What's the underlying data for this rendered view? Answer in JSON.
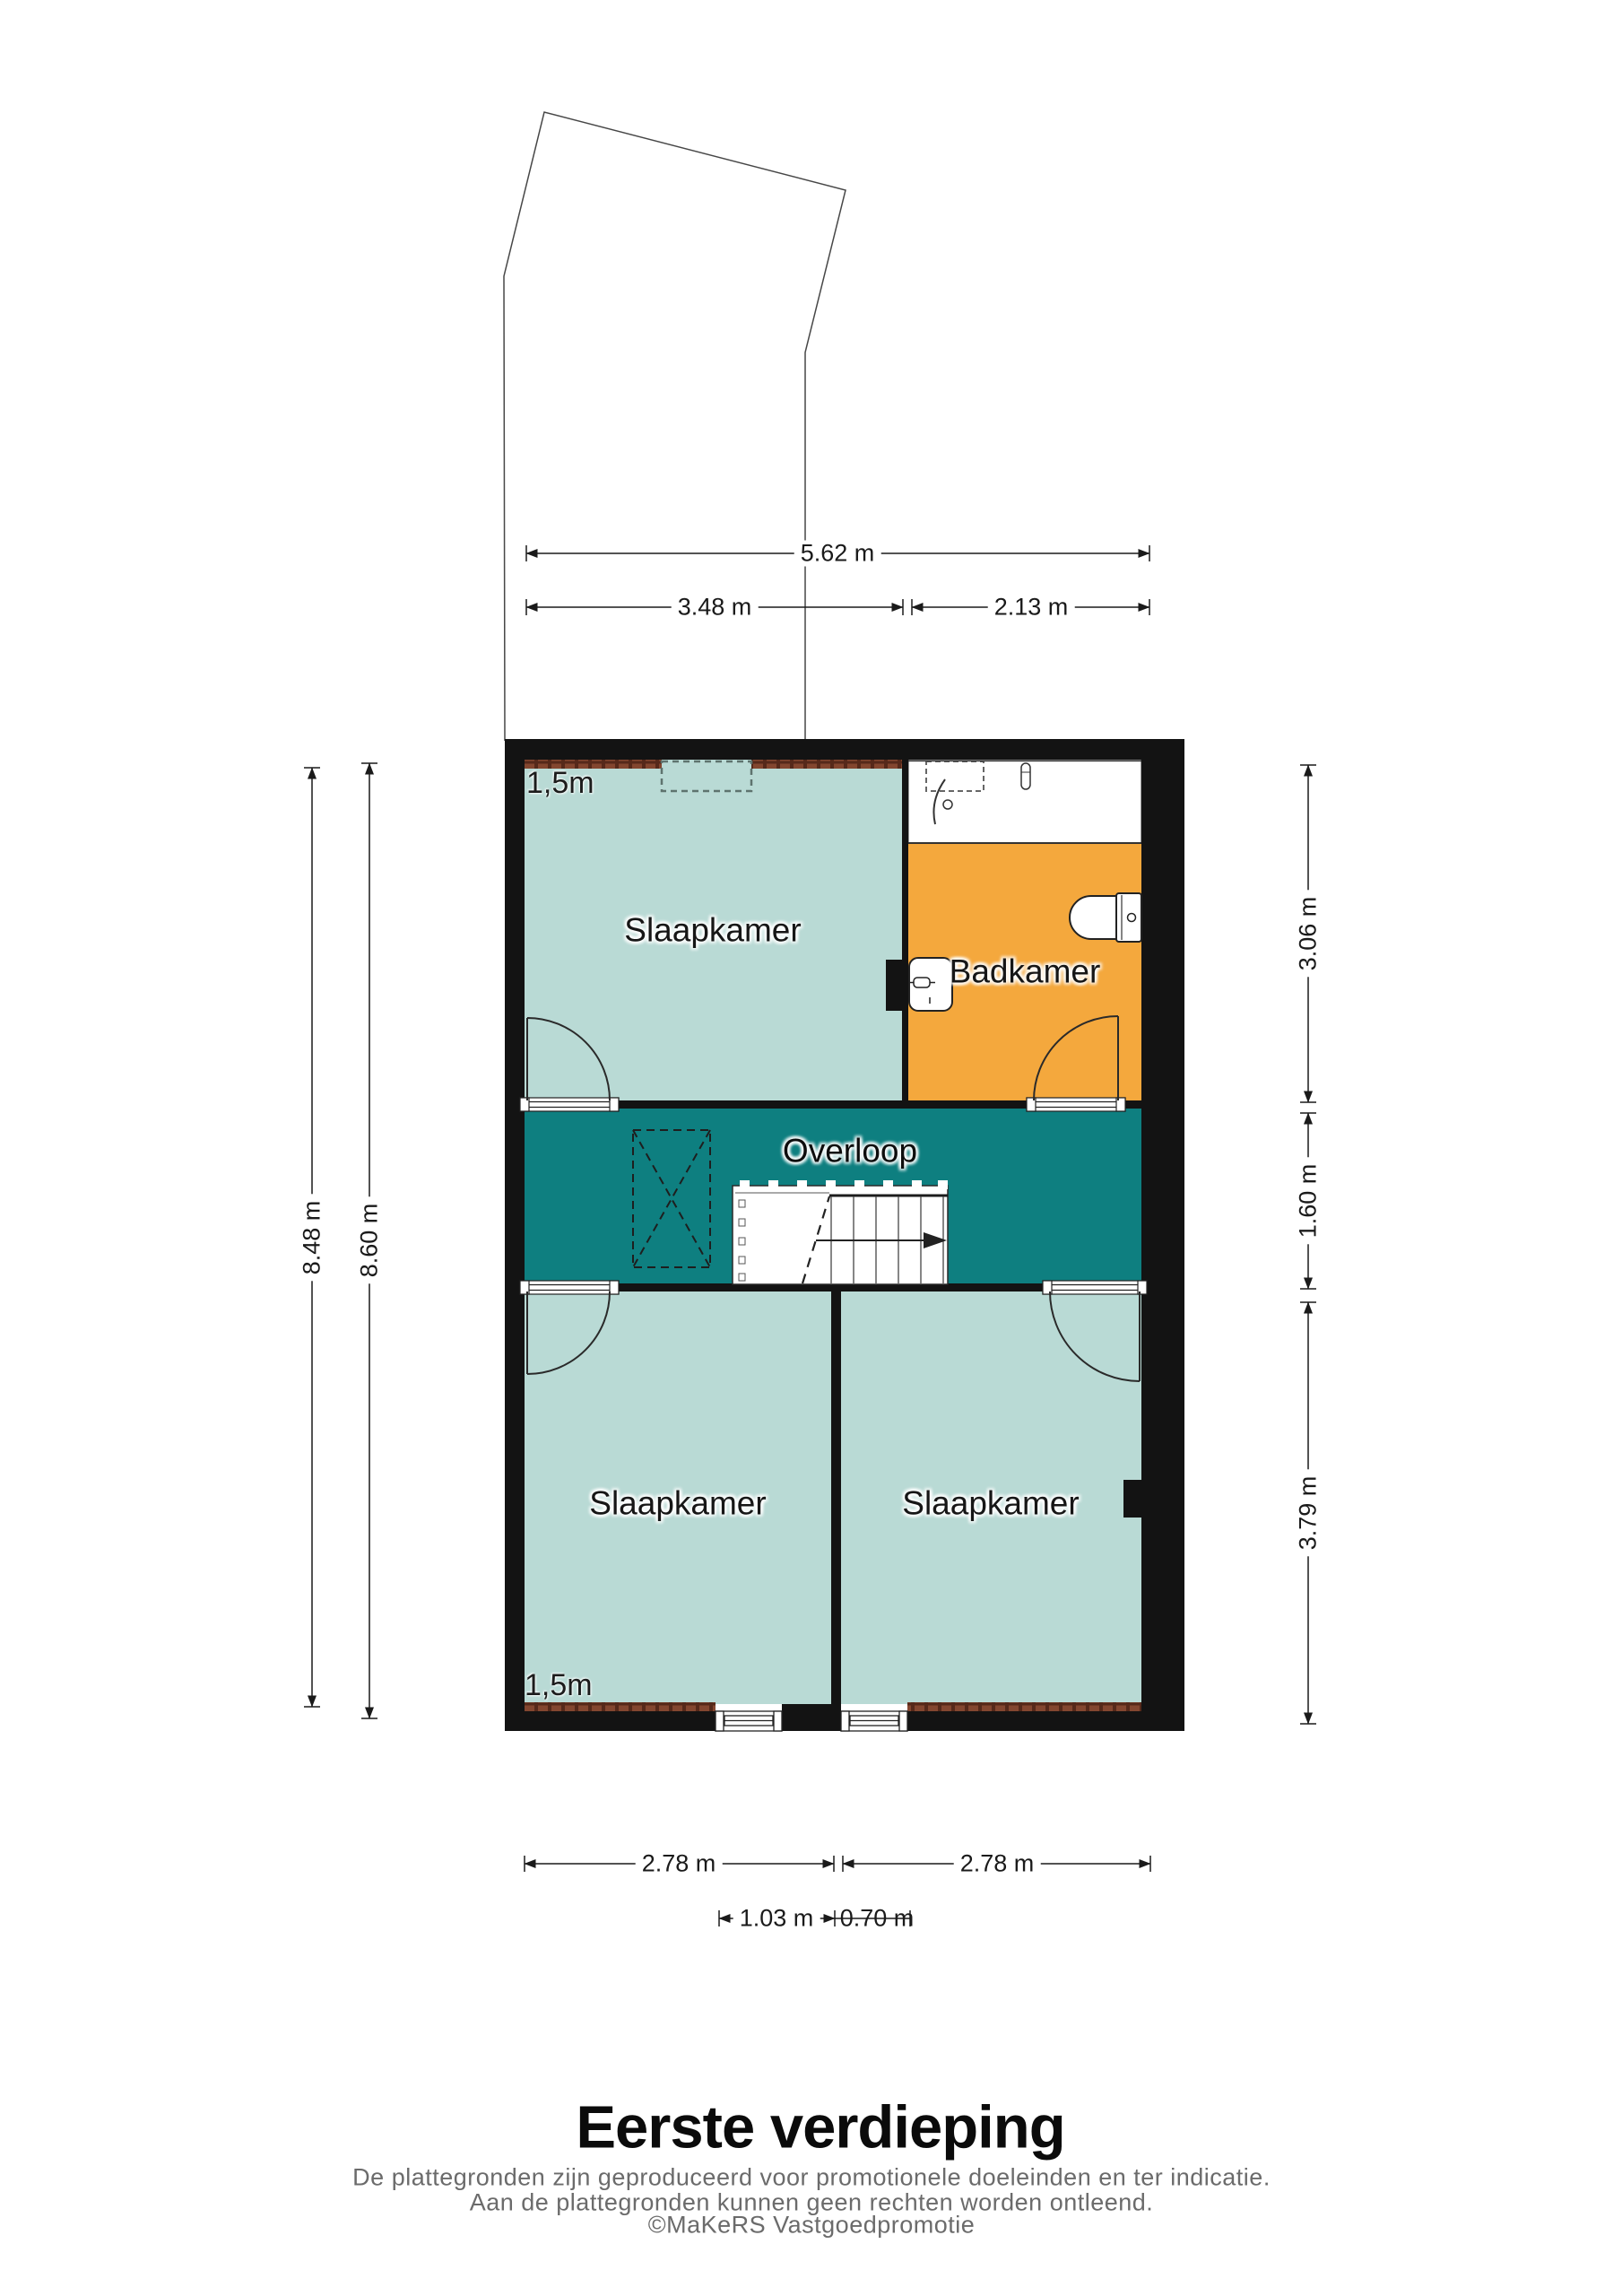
{
  "title": "Eerste verdieping",
  "footer": {
    "line1": "De plattegronden zijn geproduceerd voor promotionele doeleinden en ter indicatie.",
    "line2": "Aan de plattegronden kunnen geen rechten worden ontleend.",
    "line3": "©MaKeRS Vastgoedpromotie"
  },
  "rooms": {
    "bedroom_top": "Slaapkamer",
    "bathroom": "Badkamer",
    "landing": "Overloop",
    "bedroom_bottom_left": "Slaapkamer",
    "bedroom_bottom_right": "Slaapkamer"
  },
  "annotations": {
    "headroom_top": "1,5m",
    "headroom_bottom": "1,5m"
  },
  "dimensions": {
    "top_total": "5.62 m",
    "top_left": "3.48 m",
    "top_right": "2.13 m",
    "left_outer": "8.48 m",
    "left_inner": "8.60 m",
    "right_top": "3.06 m",
    "right_middle": "1.60 m",
    "right_bottom": "3.79 m",
    "bottom_left": "2.78 m",
    "bottom_right": "2.78 m",
    "detail_left": "1.03 m",
    "detail_right": "0.70 m"
  },
  "colors": {
    "room_fill": "#b9dad5",
    "landing_fill": "#0e7f80",
    "bathroom_fill": "#f4a83d",
    "wall": "#131313",
    "hatch_base": "#83462f",
    "hatch_dark": "#56291a",
    "dim_color": "#1a1a1a",
    "footer_color": "#6b6b6b"
  }
}
